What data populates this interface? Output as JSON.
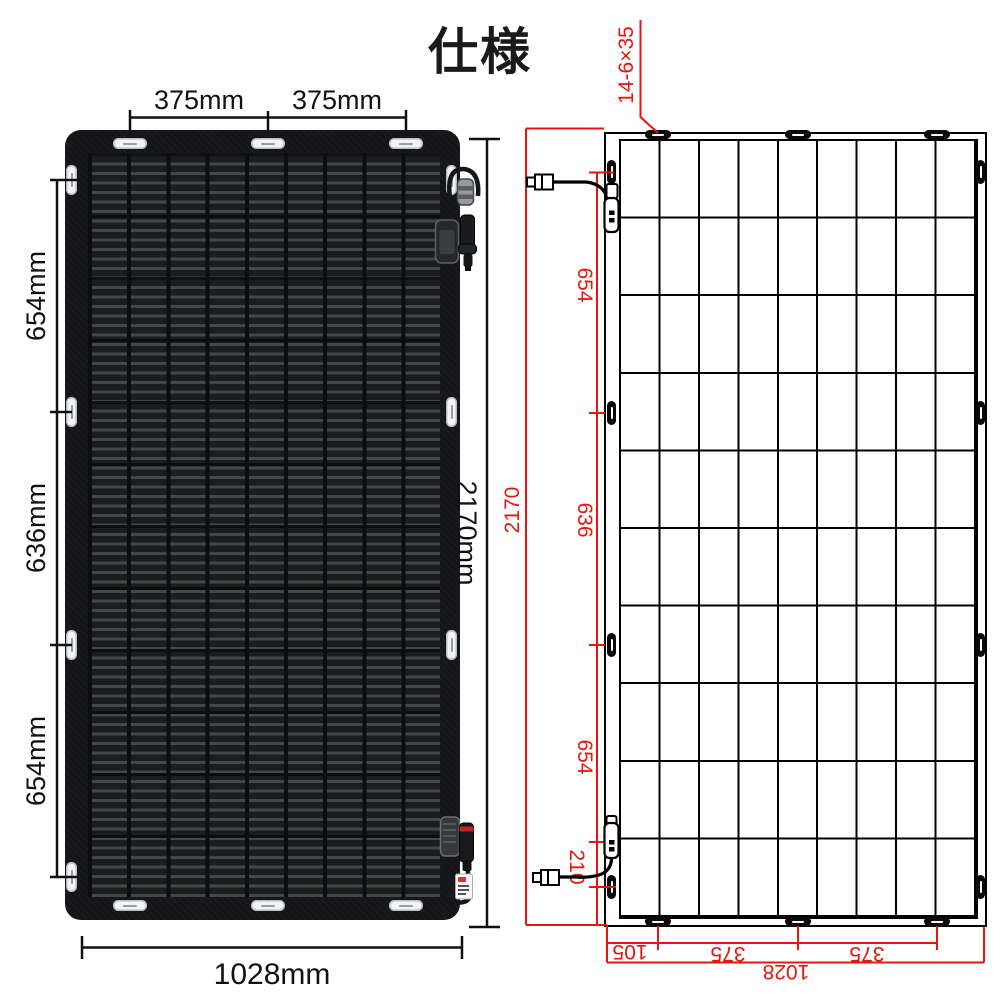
{
  "title": "仕様",
  "colors": {
    "dim_red": "#e8150f",
    "dim_black": "#111111",
    "panel_dark": "#1d1f22"
  },
  "left_figure": {
    "name": "solar-panel-photo",
    "dim_top": [
      "375mm",
      "375mm"
    ],
    "dim_left": [
      "654mm",
      "636mm",
      "654mm"
    ],
    "dim_right": "2170mm",
    "dim_bottom": "1028mm"
  },
  "right_figure": {
    "name": "solar-panel-technical-drawing",
    "hole_spec": "14-6×35",
    "dim_outer_left": "2170",
    "dim_left": [
      "654",
      "636",
      "654"
    ],
    "dim_bottom_offset": "210",
    "dim_bottom": [
      "105",
      "375",
      "375"
    ],
    "dim_bottom_total": "1028",
    "grid": {
      "columns": 9,
      "rows": 10,
      "mounting_holes": 14
    }
  }
}
